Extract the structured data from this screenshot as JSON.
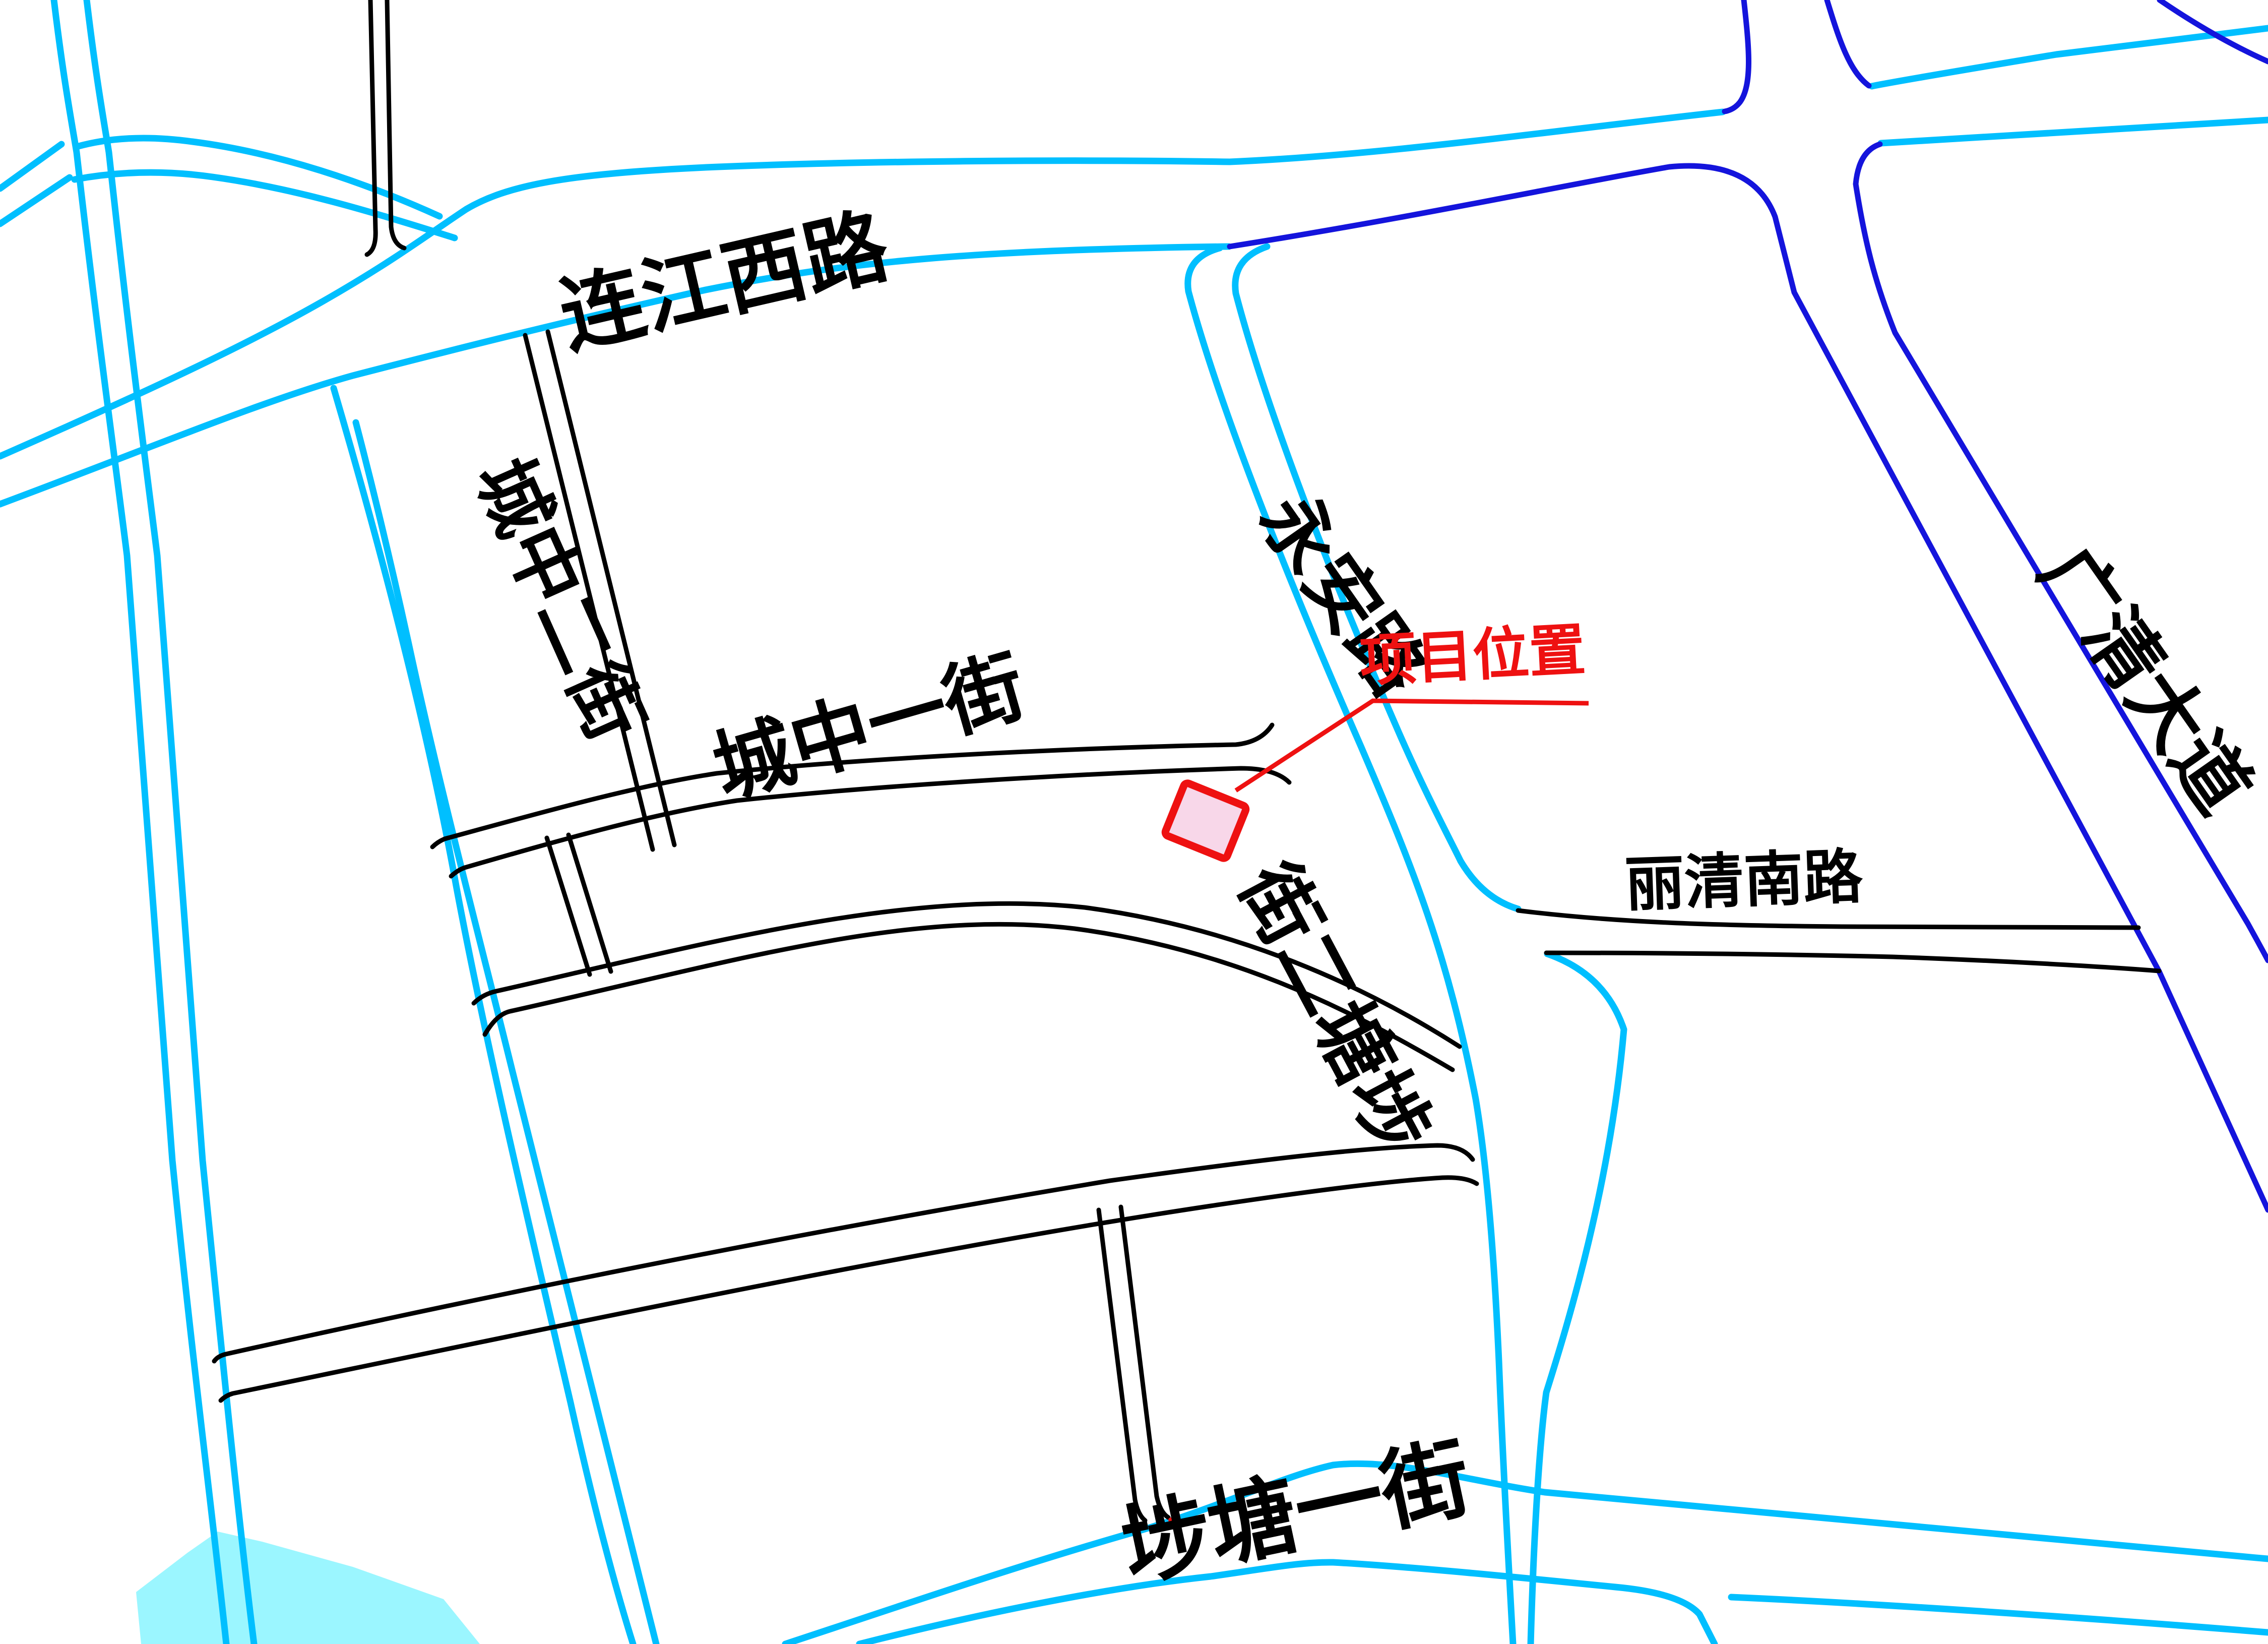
{
  "colors": {
    "road_cyan": "#00BFFF",
    "road_blue": "#1414DC",
    "road_black": "#000000",
    "marker_red": "#EE1111",
    "marker_fill": "#F8D7E9",
    "water_fill": "#9BF6FF"
  },
  "labels": {
    "lianjiang_xi_lu": "连江西路",
    "chengzhong_er_jie": "城中二街",
    "chengzhong_yi_jie": "城中一街",
    "yongan_lu": "永安路",
    "butang_er_jie": "埗塘二街",
    "butang_er_jie_display": "街二塘埗",
    "butang_yi_jie": "埗塘一街",
    "liqing_nan_lu": "丽清南路",
    "guangqing_dadao": "广清大道"
  },
  "marker": {
    "label": "项目位置"
  }
}
